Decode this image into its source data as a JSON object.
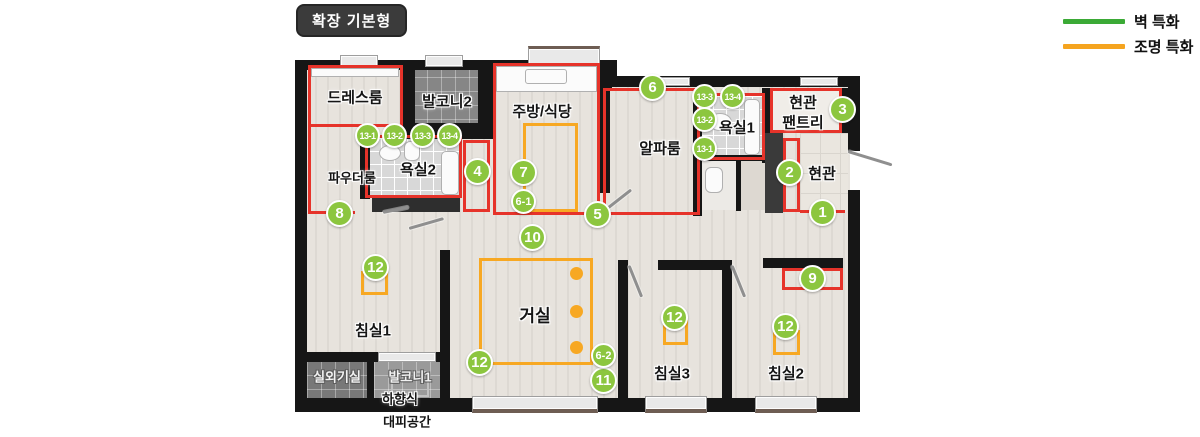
{
  "header": {
    "title": "확장 기본형"
  },
  "legend": {
    "wall": {
      "label": "벽 특화",
      "color": "#3baa36"
    },
    "light": {
      "label": "조명 특화",
      "color": "#f5a41f"
    }
  },
  "colors": {
    "wall_accent_red": "#e6332a",
    "light_accent_orange": "#f7a823",
    "badge_green": "#8cc63f",
    "wall_black": "#161616",
    "floor": "#e4e0da"
  },
  "rooms": {
    "dressroom": "드레스룸",
    "balcony2": "발코니2",
    "kitchen": "주방/식당",
    "alpha": "알파룸",
    "pantry_l1": "현관",
    "pantry_l2": "팬트리",
    "bath1": "욕실1",
    "bath2": "욕실2",
    "powder": "파우더룸",
    "entrance": "현관",
    "bed1": "침실1",
    "living": "거실",
    "bed3": "침실3",
    "bed2": "침실2",
    "outdoor_unit": "실외기실",
    "balcony1": "발코니1",
    "evac_l1": "하향식",
    "evac_l2": "대피공간"
  },
  "badges": {
    "b1": "1",
    "b2": "2",
    "b3": "3",
    "b4": "4",
    "b5": "5",
    "b6": "6",
    "b7": "7",
    "b8": "8",
    "b9": "9",
    "b10": "10",
    "b11": "11",
    "b12": "12",
    "b6_1": "6-1",
    "b6_2": "6-2",
    "b13_1": "13-1",
    "b13_2": "13-2",
    "b13_3": "13-3",
    "b13_4": "13-4"
  }
}
